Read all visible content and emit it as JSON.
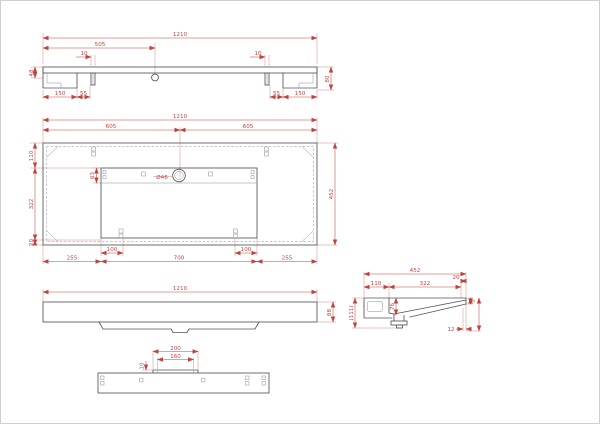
{
  "colors": {
    "dimension": "#bf4440",
    "object_line": "#54555a",
    "hatch_dot": "#9a958c"
  },
  "views": {
    "section": {
      "dims": {
        "overall": "1210",
        "hole_offset": "505",
        "clip_left": "10",
        "clip_right": "10",
        "height_left": "48",
        "height_right": "80",
        "end_left": "150",
        "slot_left": "55",
        "slot_right": "55",
        "end_right": "150"
      }
    },
    "plan": {
      "dims": {
        "overall": "1210",
        "half_left": "605",
        "half_right": "605",
        "front_edge": "110",
        "basin_depth": "322",
        "back_edge": "20",
        "depth": "452",
        "drain": "Ø46",
        "slot_height": "63",
        "tab_left": "100",
        "tab_right": "100",
        "seg_left": "255",
        "seg_center": "700",
        "seg_right": "255"
      }
    },
    "front": {
      "dims": {
        "overall": "1210",
        "height": "88"
      }
    },
    "side": {
      "dims": {
        "overall": "452",
        "back": "110",
        "basin": "322",
        "lip": "20",
        "total_height": "(111)",
        "basin_depth": "76",
        "edge": "5",
        "offset": "12"
      }
    },
    "rail": {
      "dims": {
        "tab_outer": "200",
        "tab_inner": "160",
        "tab_height": "10"
      }
    }
  }
}
